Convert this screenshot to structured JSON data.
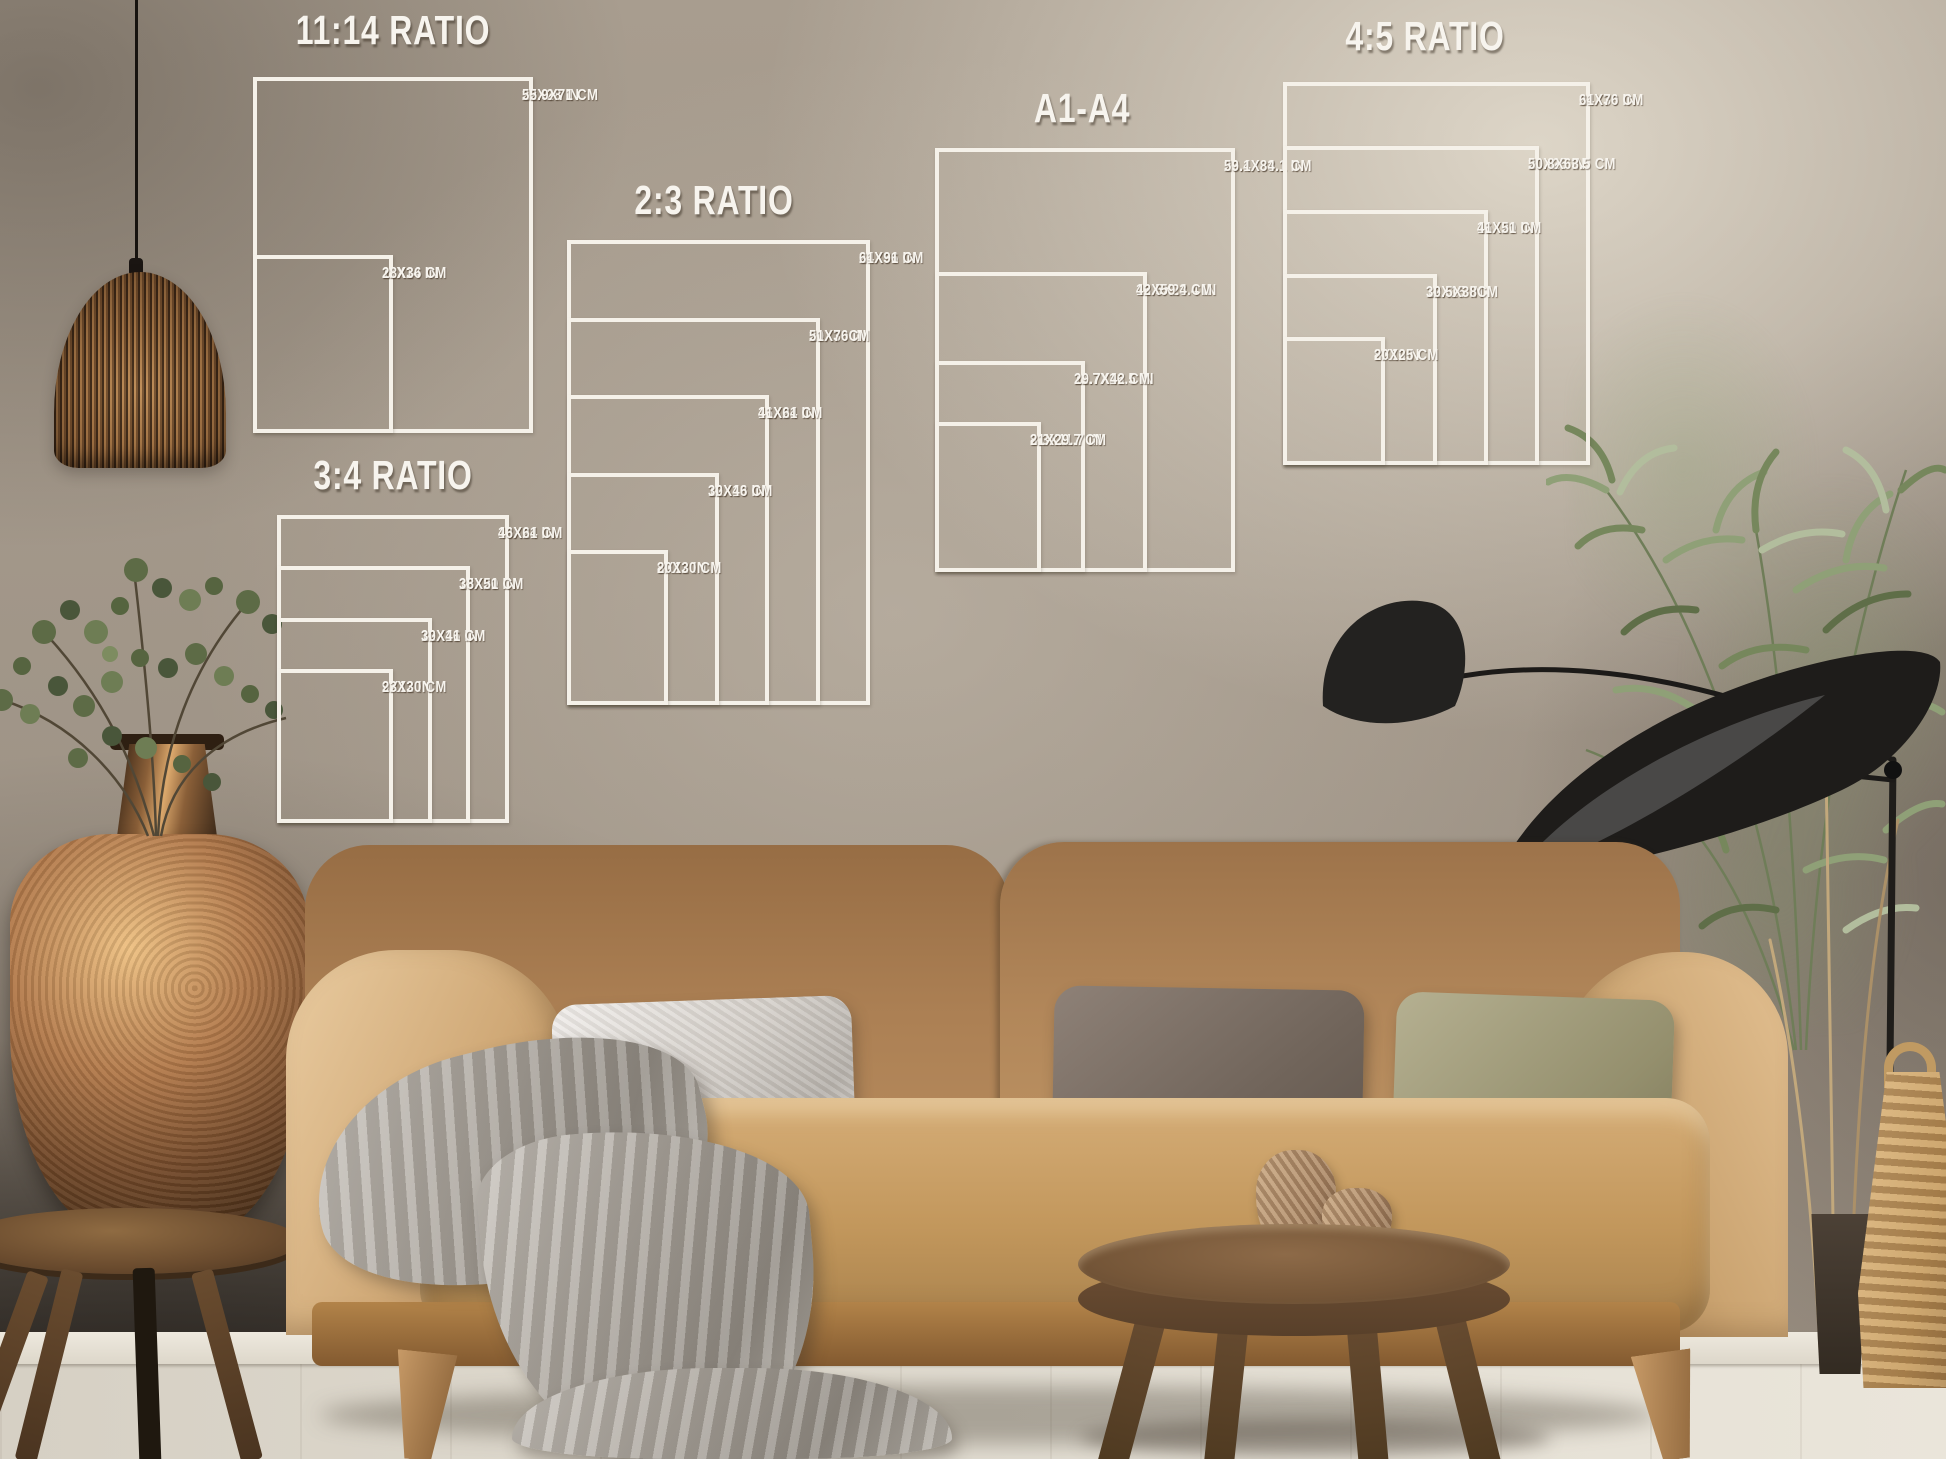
{
  "style": {
    "chart_line_color": "#f5f1e9",
    "chart_text_color": "#f7f4ee",
    "wall_color": "#a89d8f",
    "sofa_color": "#c2975c",
    "pillow_colors": [
      "#d3cec8",
      "#70645a",
      "#948f6d"
    ]
  },
  "charts": [
    {
      "id": "11-14-ratio",
      "title": "11:14 RATIO",
      "title_x": 393,
      "title_y": 10,
      "box": {
        "left": 253,
        "top": 77,
        "width": 280,
        "height": 356
      },
      "sizes": [
        {
          "label_in": "22X28 IN",
          "label_cm": "55.9X71 CM",
          "w": 22,
          "h": 28
        },
        {
          "label_in": "11X14 IN",
          "label_cm": "28X36 CM",
          "w": 11,
          "h": 14
        }
      ]
    },
    {
      "id": "2-3-ratio",
      "title": "2:3 RATIO",
      "title_x": 714,
      "title_y": 180,
      "box": {
        "left": 567,
        "top": 240,
        "width": 303,
        "height": 465
      },
      "sizes": [
        {
          "label_in": "24X36 IN",
          "label_cm": "61X91 CM",
          "w": 24,
          "h": 36
        },
        {
          "label_in": "20X30 IN",
          "label_cm": "51X76CM",
          "w": 20,
          "h": 30
        },
        {
          "label_in": "16X24 IN",
          "label_cm": "41X61 CM",
          "w": 16,
          "h": 24
        },
        {
          "label_in": "12X18 IN",
          "label_cm": "30X46 CM",
          "w": 12,
          "h": 18
        },
        {
          "label_in": "8X12 IN",
          "label_cm": "20X30 CM",
          "w": 8,
          "h": 12
        }
      ]
    },
    {
      "id": "3-4-ratio",
      "title": "3:4 RATIO",
      "title_x": 393,
      "title_y": 455,
      "box": {
        "left": 277,
        "top": 515,
        "width": 232,
        "height": 308
      },
      "sizes": [
        {
          "label_in": "18X24 IN",
          "label_cm": "46X61 CM",
          "w": 18,
          "h": 24
        },
        {
          "label_in": "15X20 IN",
          "label_cm": "38X51 CM",
          "w": 15,
          "h": 20
        },
        {
          "label_in": "12X16 IN",
          "label_cm": "30X41 CM",
          "w": 12,
          "h": 16
        },
        {
          "label_in": "9X12 IN",
          "label_cm": "23X30 CM",
          "w": 9,
          "h": 12
        }
      ]
    },
    {
      "id": "a1-a4",
      "title": "A1-A4",
      "title_x": 1082,
      "title_y": 88,
      "box": {
        "left": 935,
        "top": 148,
        "width": 300,
        "height": 424
      },
      "sizes": [
        {
          "label_in": "23.4X33.1 IN",
          "label_cm": "59.1X84.1 CM",
          "w": 23.4,
          "h": 33.1
        },
        {
          "label_in": "16.5X23.4 IN",
          "label_cm": "42X59.4 CM",
          "w": 16.5,
          "h": 23.4
        },
        {
          "label_in": "11.7X16.5 IN",
          "label_cm": "29.7X42 CM",
          "w": 11.7,
          "h": 16.5
        },
        {
          "label_in": "8.3X11.7 IN",
          "label_cm": "21X29.7 CM",
          "w": 8.3,
          "h": 11.7
        }
      ]
    },
    {
      "id": "4-5-ratio",
      "title": "4:5 RATIO",
      "title_x": 1425,
      "title_y": 16,
      "box": {
        "left": 1283,
        "top": 82,
        "width": 307,
        "height": 383
      },
      "sizes": [
        {
          "label_in": "24X30 IN",
          "label_cm": "61X76 CM",
          "w": 24,
          "h": 30
        },
        {
          "label_in": "20X25 IN",
          "label_cm": "50.8X63.5 CM",
          "w": 20,
          "h": 25
        },
        {
          "label_in": "16X20 IN",
          "label_cm": "41X51 CM",
          "w": 16,
          "h": 20
        },
        {
          "label_in": "12X15 IN",
          "label_cm": "30.5X38CM",
          "w": 12,
          "h": 15
        },
        {
          "label_in": "8X10IN",
          "label_cm": "20X25 CM",
          "w": 8,
          "h": 10
        }
      ]
    }
  ]
}
